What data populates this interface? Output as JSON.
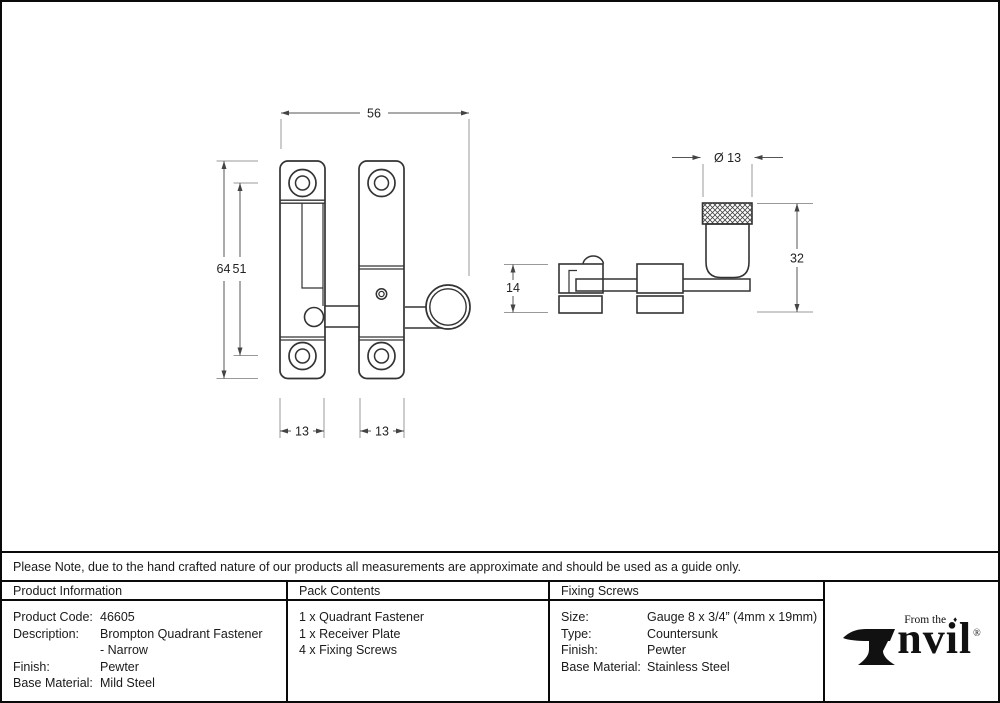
{
  "note": {
    "text": "Please Note, due to the hand crafted nature of our products all measurements are approximate and should be used as a guide only."
  },
  "table": {
    "product_information": {
      "header": "Product Information",
      "rows": [
        {
          "label": "Product Code:",
          "value": "46605"
        },
        {
          "label": "Description:",
          "value": "Brompton Quadrant Fastener"
        },
        {
          "label": "",
          "value": "- Narrow"
        },
        {
          "label": "Finish:",
          "value": "Pewter"
        },
        {
          "label": "Base Material:",
          "value": "Mild Steel"
        }
      ]
    },
    "pack_contents": {
      "header": "Pack Contents",
      "items": [
        "1 x Quadrant Fastener",
        "1 x Receiver Plate",
        "4 x Fixing Screws"
      ]
    },
    "fixing_screws": {
      "header": "Fixing Screws",
      "rows": [
        {
          "label": "Size:",
          "value": "Gauge 8 x 3/4” (4mm x 19mm)"
        },
        {
          "label": "Type:",
          "value": "Countersunk"
        },
        {
          "label": "Finish:",
          "value": "Pewter"
        },
        {
          "label": "Base Material:",
          "value": "Stainless Steel"
        }
      ]
    }
  },
  "logo": {
    "tagline": "From the",
    "diamond": "♦",
    "word": "nvil",
    "registered": "®"
  },
  "drawing": {
    "front_view": {
      "overall_width_mm": "56",
      "overall_height_mm": "64",
      "hole_spacing_mm": "51",
      "left_plate_width_mm": "13",
      "right_plate_width_mm": "13"
    },
    "side_view": {
      "knob_diameter_mm": "Ø 13",
      "knob_height_mm": "32",
      "receiver_height_mm": "14"
    }
  },
  "colors": {
    "outline": "#333333",
    "dimension_line": "#555555",
    "extension_line": "#999999",
    "border": "#0a0a0a"
  }
}
